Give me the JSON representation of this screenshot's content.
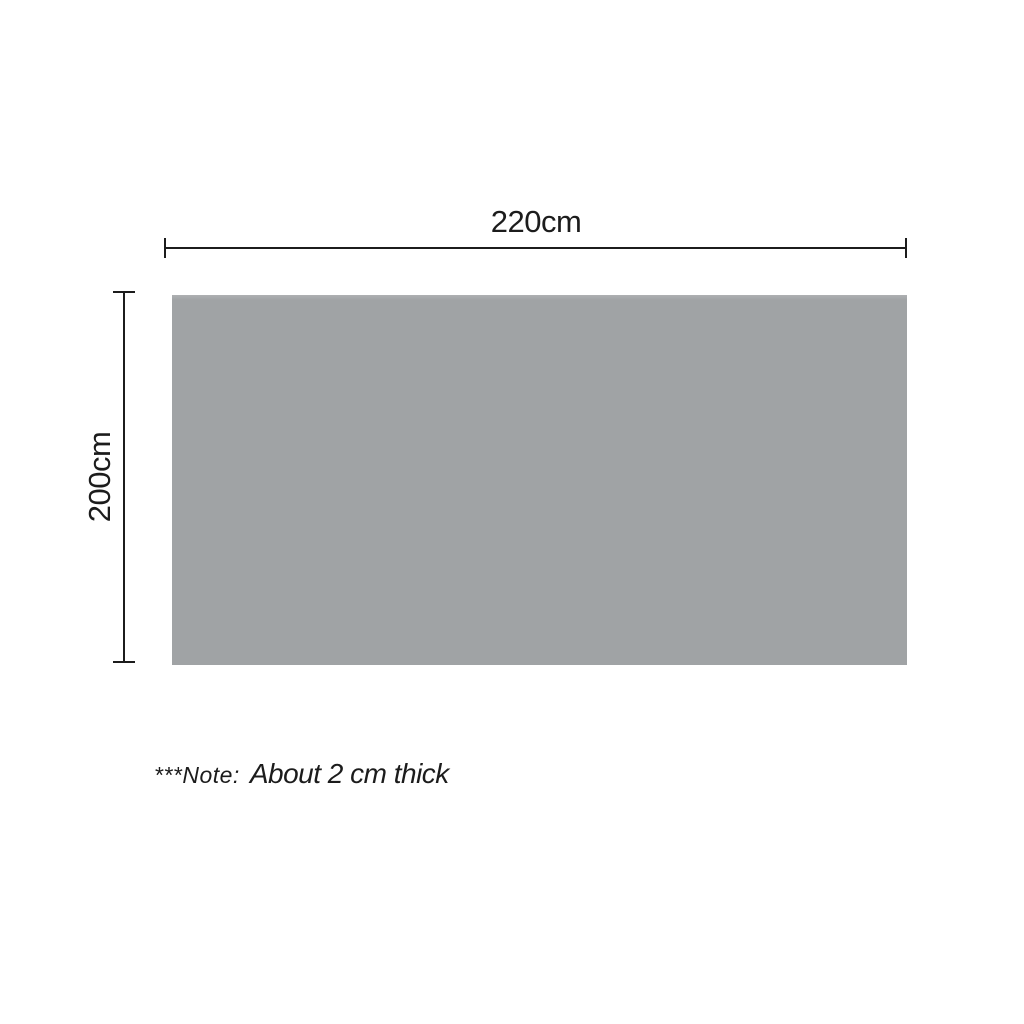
{
  "diagram": {
    "width_label": "220cm",
    "height_label": "200cm",
    "note_prefix": "***Note:",
    "note_text": "About 2 cm thick"
  },
  "colors": {
    "background": "#ffffff",
    "panel_fill": "#a0a3a5",
    "line": "#1c1c1c",
    "text": "#1c1c1c"
  }
}
